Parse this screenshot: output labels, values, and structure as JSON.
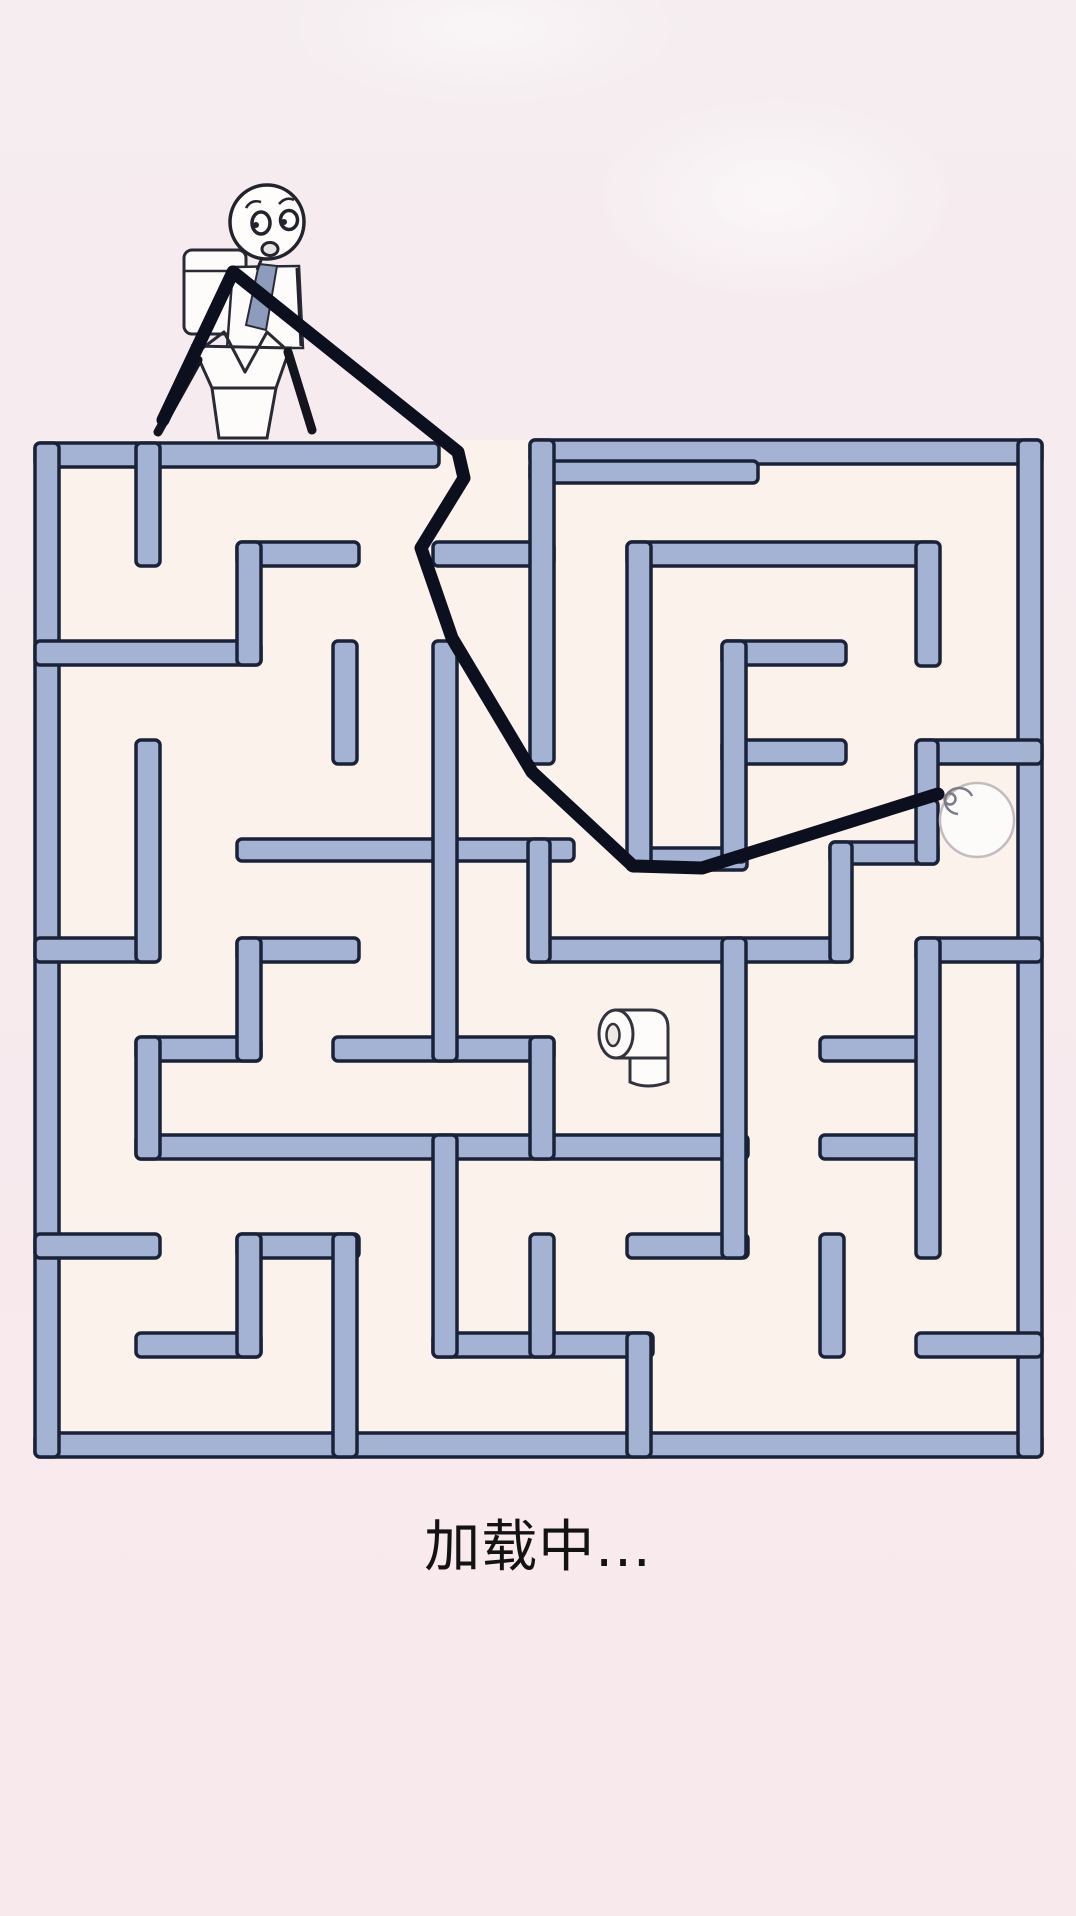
{
  "page": {
    "width": 1076,
    "height": 1916
  },
  "loading": {
    "label": "加载中..."
  },
  "colors": {
    "background_top": "#f5edf0",
    "background_bottom": "#f8e9ec",
    "maze_floor": "#fbf2ec",
    "wall_fill": "#a4b2d3",
    "wall_outline": "#1a2238",
    "thread": "#0b0f1e",
    "figure_outline": "#23232d",
    "paper_white": "#fdfcfb",
    "tie": "#8d9cbd",
    "ball_outline": "#c3bcbe",
    "swirl": "#7a7a88",
    "text": "#131313"
  },
  "maze": {
    "x": 35,
    "y": 440,
    "width": 1008,
    "height": 1018,
    "entrance_gap": {
      "x1": 439,
      "x2": 530
    },
    "walls": [
      [
        35,
        443,
        404,
        24
      ],
      [
        530,
        440,
        512,
        24
      ],
      [
        530,
        461,
        228,
        22
      ],
      [
        35,
        1433,
        1007,
        24
      ],
      [
        35,
        443,
        24,
        1014
      ],
      [
        1018,
        440,
        24,
        1017
      ],
      [
        237,
        542,
        122,
        24
      ],
      [
        433,
        542,
        121,
        24
      ],
      [
        627,
        542,
        310,
        24
      ],
      [
        35,
        641,
        226,
        24
      ],
      [
        722,
        641,
        124,
        24
      ],
      [
        722,
        740,
        124,
        24
      ],
      [
        916,
        740,
        126,
        24
      ],
      [
        237,
        839,
        337,
        22
      ],
      [
        627,
        848,
        120,
        22
      ],
      [
        830,
        842,
        108,
        22
      ],
      [
        35,
        938,
        124,
        24
      ],
      [
        237,
        938,
        122,
        24
      ],
      [
        530,
        938,
        318,
        24
      ],
      [
        916,
        938,
        126,
        24
      ],
      [
        333,
        1037,
        221,
        24
      ],
      [
        820,
        1037,
        118,
        24
      ],
      [
        136,
        1037,
        125,
        24
      ],
      [
        136,
        1135,
        612,
        24
      ],
      [
        820,
        1135,
        118,
        24
      ],
      [
        35,
        1234,
        125,
        24
      ],
      [
        237,
        1234,
        122,
        24
      ],
      [
        627,
        1234,
        121,
        24
      ],
      [
        136,
        1333,
        125,
        24
      ],
      [
        433,
        1333,
        220,
        24
      ],
      [
        916,
        1333,
        126,
        24
      ],
      [
        136,
        443,
        24,
        123
      ],
      [
        237,
        542,
        24,
        123
      ],
      [
        333,
        641,
        24,
        123
      ],
      [
        136,
        740,
        24,
        222
      ],
      [
        433,
        641,
        24,
        420
      ],
      [
        530,
        440,
        24,
        324
      ],
      [
        627,
        542,
        24,
        328
      ],
      [
        722,
        641,
        24,
        221
      ],
      [
        916,
        542,
        24,
        124
      ],
      [
        916,
        740,
        22,
        60
      ],
      [
        916,
        800,
        22,
        64
      ],
      [
        830,
        842,
        22,
        120
      ],
      [
        528,
        839,
        22,
        123
      ],
      [
        916,
        938,
        24,
        320
      ],
      [
        722,
        938,
        24,
        320
      ],
      [
        530,
        1037,
        24,
        122
      ],
      [
        237,
        938,
        24,
        123
      ],
      [
        136,
        1037,
        24,
        122
      ],
      [
        237,
        1234,
        24,
        123
      ],
      [
        333,
        1234,
        24,
        223
      ],
      [
        433,
        1135,
        24,
        222
      ],
      [
        530,
        1234,
        24,
        123
      ],
      [
        627,
        1333,
        24,
        124
      ],
      [
        820,
        1234,
        24,
        123
      ]
    ]
  },
  "thread": {
    "width": 13,
    "main_points": "233,272 458,452 464,478 421,548 452,638 532,772 633,866 702,868 938,794",
    "dangle_points": "233,272 163,420"
  },
  "ball": {
    "cx": 977,
    "cy": 820,
    "r": 37
  },
  "paper_roll": {
    "x": 598,
    "y": 1006
  }
}
